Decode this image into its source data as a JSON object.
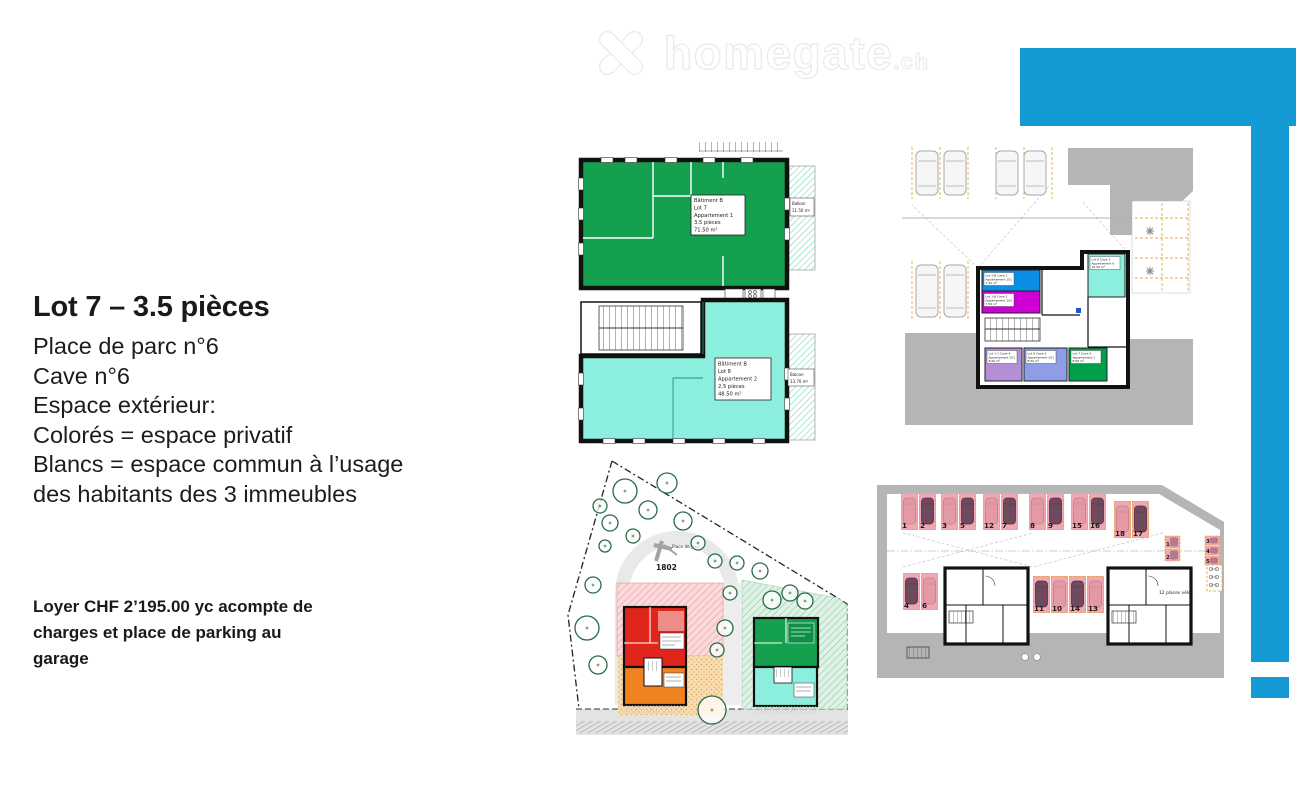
{
  "watermark": {
    "brand": "homegate",
    "tld": ".ch"
  },
  "info": {
    "title": "Lot 7 – 3.5 pièces",
    "lines": [
      "Place de parc n°6",
      "Cave n°6",
      "Espace extérieur:",
      "Colorés = espace privatif",
      "Blancs = espace commun à l’usage",
      "des habitants des 3 immeubles"
    ],
    "price": [
      "Loyer CHF 2’195.00 yc acompte de",
      "charges et place de parking au",
      "garage"
    ]
  },
  "colors": {
    "accent_blue": "#149ad5",
    "apartment_green": "#14a04e",
    "apartment_teal": "#8ceedd",
    "cave_blue": "#0b8fe6",
    "cave_magenta": "#cf00d4",
    "cave_lavender": "#b48fd8",
    "cave_periwinkle": "#8f9de6",
    "cave_green": "#00a04a",
    "site_red": "#e0251c",
    "site_orange": "#ef8322",
    "stall_pink": "#f1a9b1",
    "plan_gray": "#b5b5b5"
  },
  "plans": {
    "apartment": {
      "unit1": {
        "lines": [
          "Bâtiment B",
          "Lot 7",
          "Appartement 1",
          "3.5 pièces",
          "71.50 m²"
        ]
      },
      "unit2": {
        "lines": [
          "Bâtiment B",
          "Lot 8",
          "Appartement 2",
          "2.5 pièces",
          "48.50 m²"
        ]
      },
      "balcony1": {
        "lines": [
          "Balkon",
          "11.50 m²"
        ]
      },
      "balcony2": {
        "lines": [
          "Balcon",
          "13.70 m²"
        ]
      }
    },
    "cave": {
      "cells": [
        {
          "lines": [
            "Lot 1-B Cave 1",
            "Appartement 101",
            "7.50 m²"
          ]
        },
        {
          "lines": [
            "Lot 1-B Cave 2",
            "Appartement 102",
            "7.50 m²"
          ]
        },
        {
          "lines": [
            "Lot 6 Cave 3",
            "Appartement 6",
            "10.50 m²"
          ]
        },
        {
          "lines": [
            "Lot 1-1 Cave 4",
            "Appartement 201",
            "8.50 m²"
          ]
        },
        {
          "lines": [
            "Lot 8 Cave 5",
            "Appartement 101",
            "8.50 m²"
          ]
        },
        {
          "lines": [
            "Lot 7 Cave 6",
            "Appartement 1",
            "8.50 m²"
          ]
        }
      ]
    },
    "site": {
      "parcel": "1802",
      "playground": "Place de jeux"
    },
    "garage": {
      "stall_numbers": [
        "1",
        "2",
        "3",
        "5",
        "12",
        "7",
        "8",
        "9",
        "15",
        "16",
        "18",
        "17",
        "4",
        "6",
        "11",
        "10",
        "14",
        "13"
      ],
      "moto_numbers": [
        "1",
        "2",
        "3",
        "4",
        "5"
      ],
      "bike_label": "12 places vélos"
    }
  }
}
